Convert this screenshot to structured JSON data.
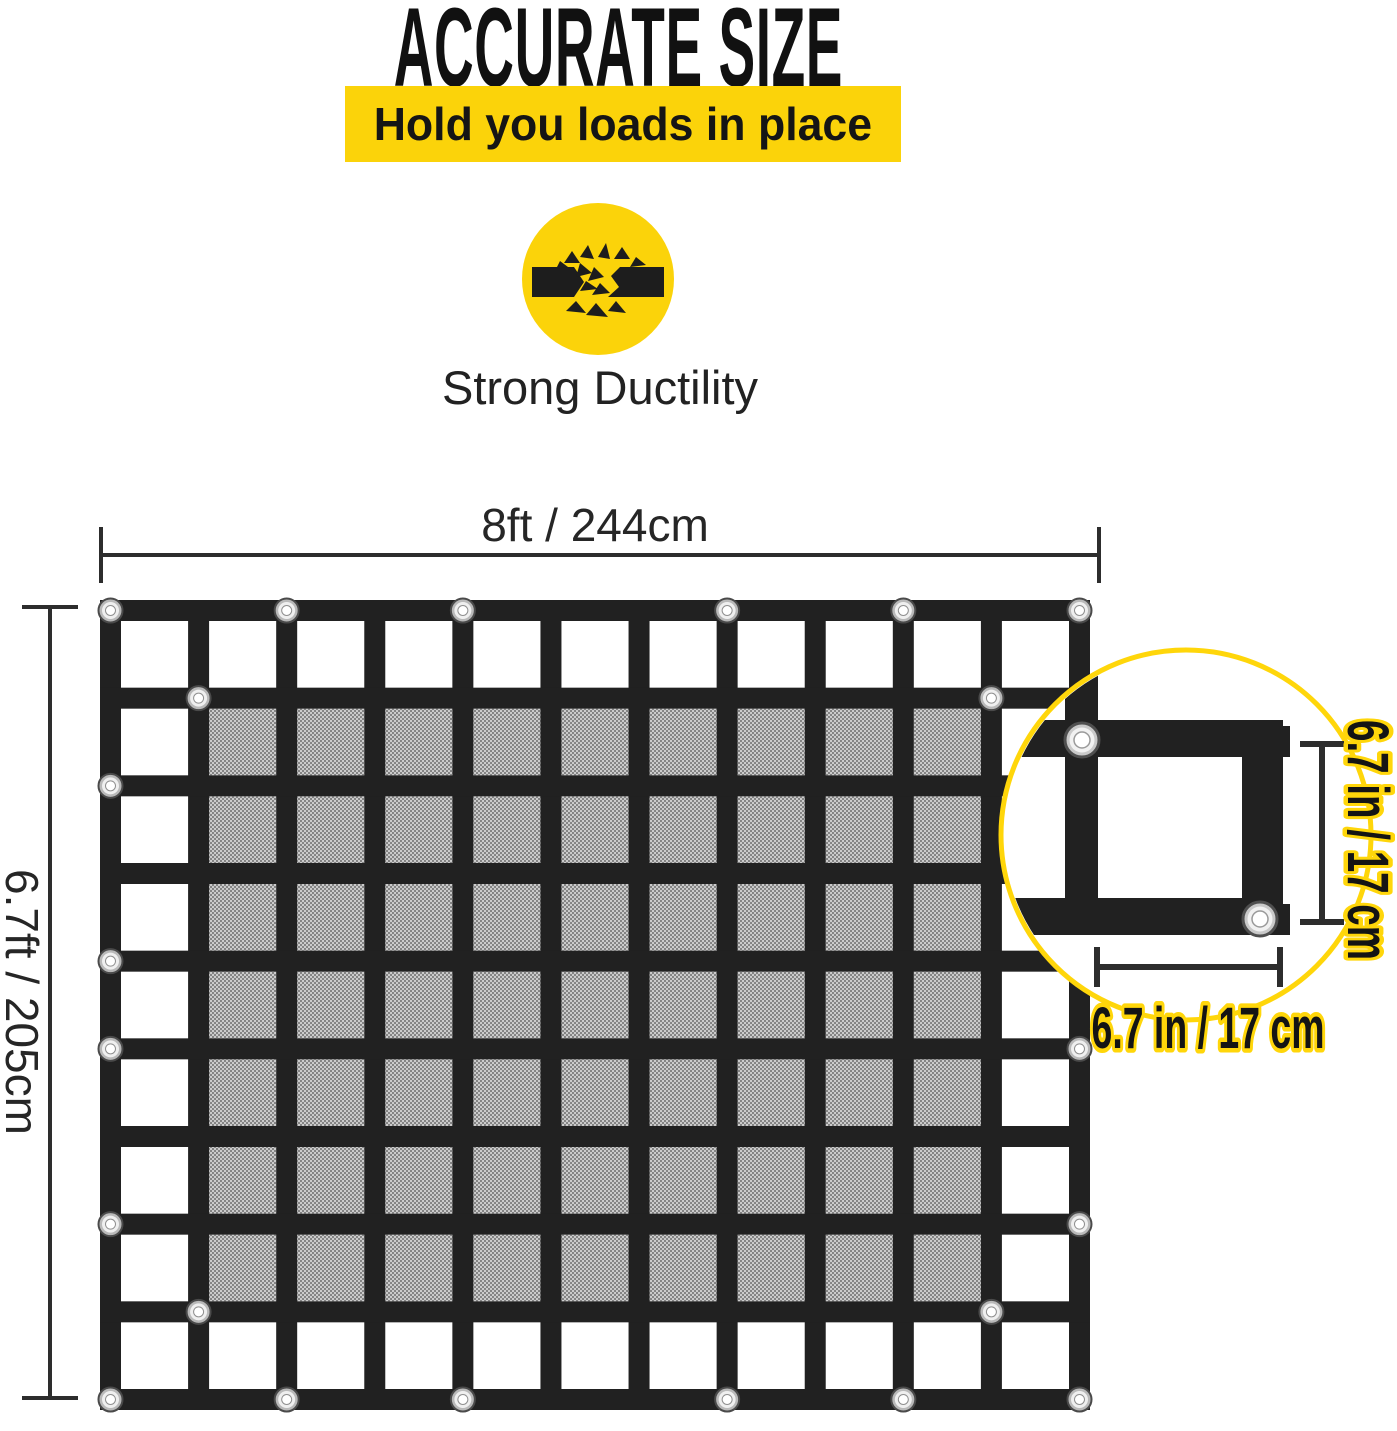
{
  "header": {
    "title": "ACCURATE SIZE",
    "banner": "Hold you loads in place",
    "feature_icon": "breaking-strap-icon",
    "feature_label": "Strong Ductility"
  },
  "dimensions": {
    "net_width": "8ft / 244cm",
    "net_height": "6.7ft / 205cm",
    "cell_width": "6.7 in / 17 cm",
    "cell_height": "6.7 in / 17 cm"
  },
  "net": {
    "x": 100,
    "y": 600,
    "width": 990,
    "height": 810,
    "columns": 11,
    "rows": 9,
    "strap_thickness": 21,
    "grommets": {
      "top": [
        0,
        2,
        4,
        7,
        9,
        11
      ],
      "bottom": [
        0,
        2,
        4,
        7,
        9,
        11
      ],
      "left": [
        2,
        4,
        5,
        7
      ],
      "right": [
        5,
        7
      ],
      "inner": [
        [
          1,
          1
        ],
        [
          10,
          1
        ],
        [
          1,
          8
        ],
        [
          10,
          8
        ]
      ]
    }
  },
  "magnifier": {
    "cx": 1186,
    "cy": 835,
    "r": 185
  },
  "colors": {
    "yellow": "#FBD30A",
    "outline_yellow": "#FFD60A",
    "strap_black": "#212121",
    "mesh_base": "#cdcdcd",
    "mesh_dot": "#7e7e7e",
    "dim_line": "#2d2d2d",
    "text_black": "#1c1c1c"
  }
}
